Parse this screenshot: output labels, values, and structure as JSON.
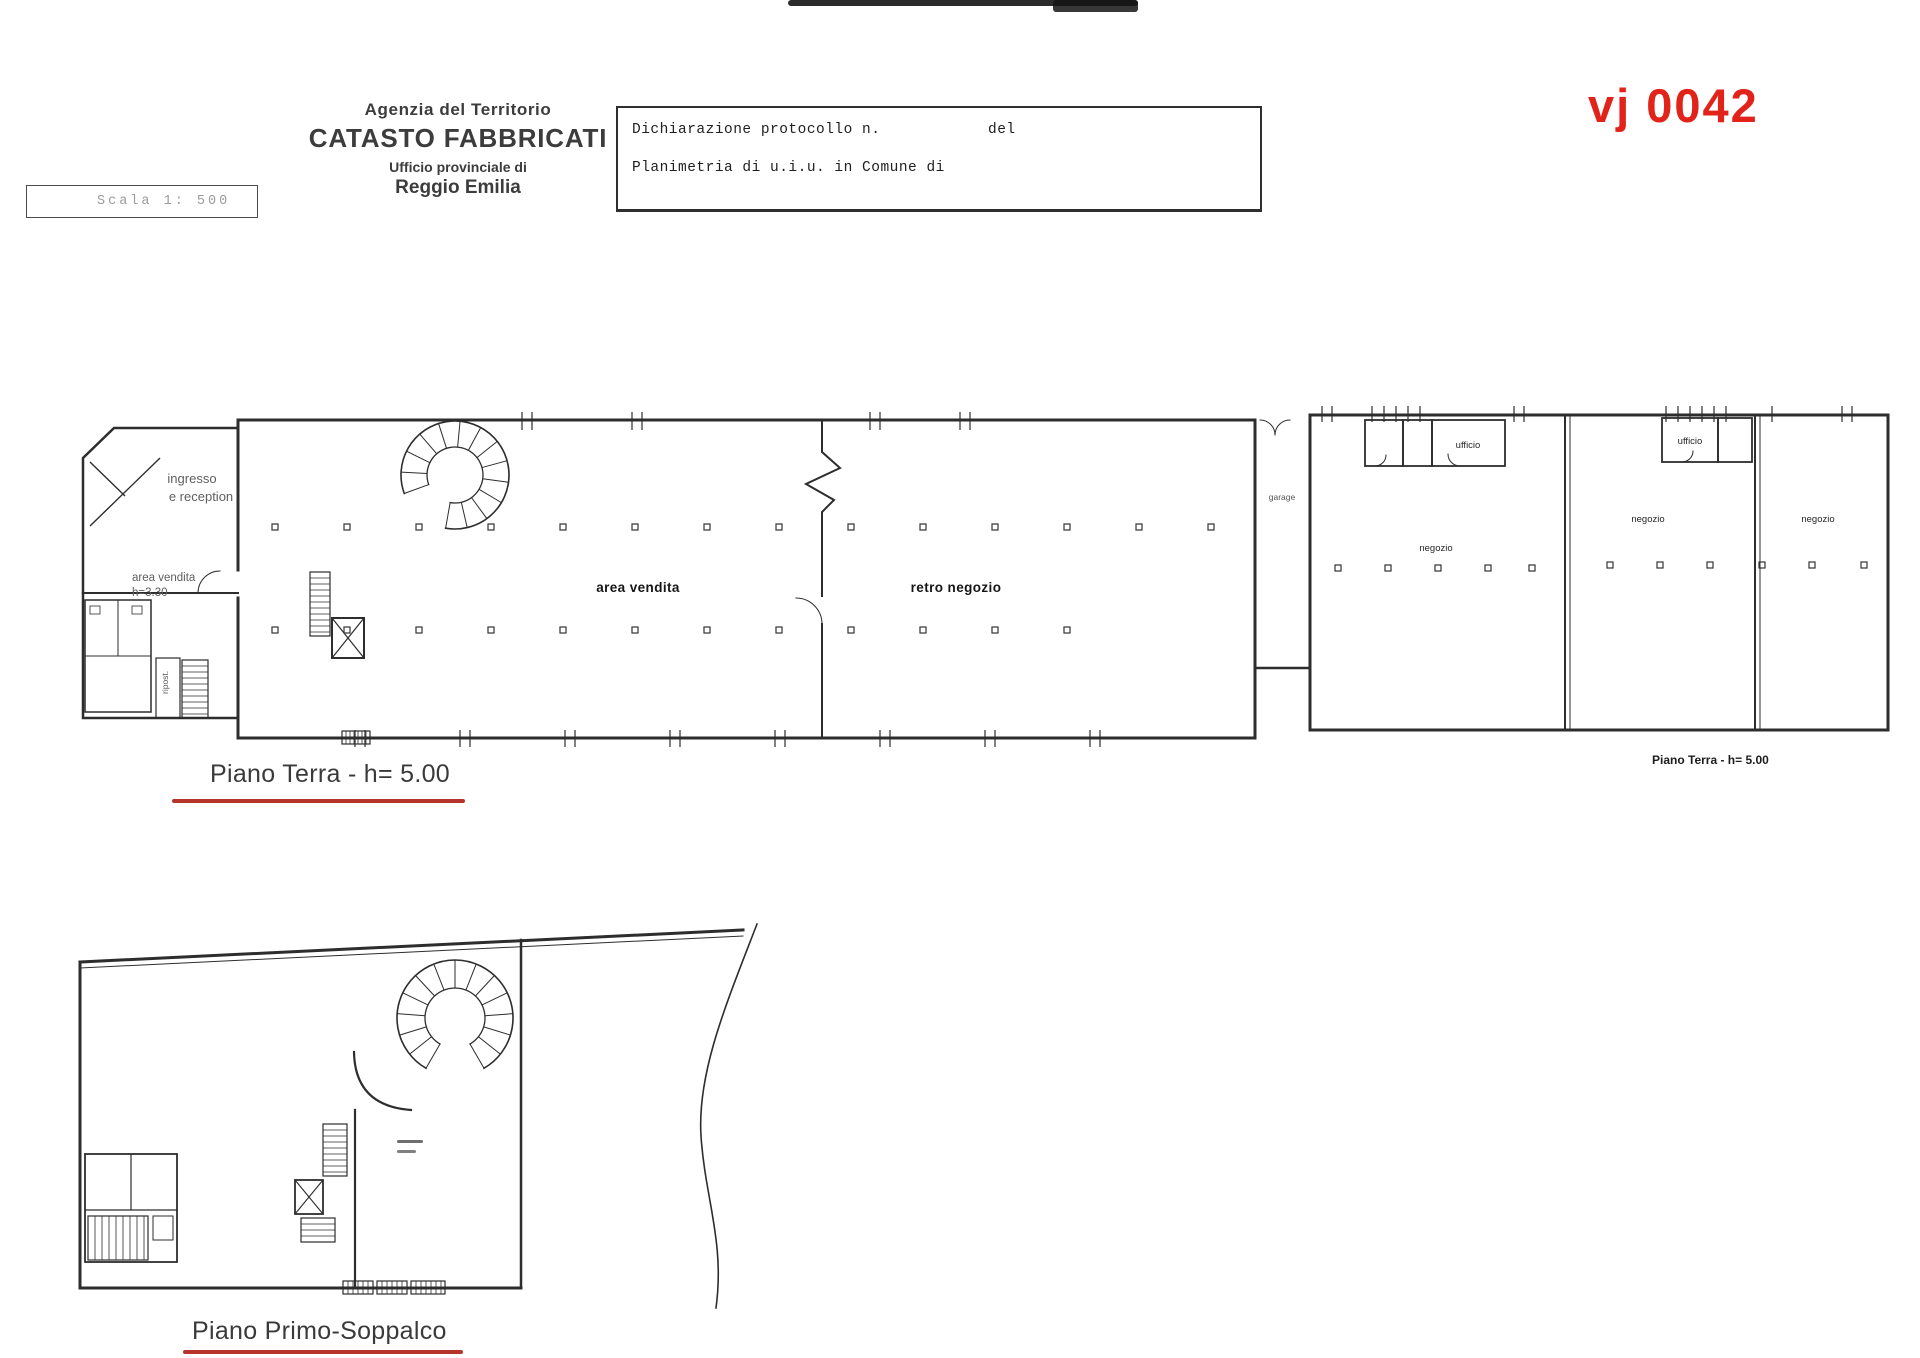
{
  "document": {
    "stamp": "vj 0042",
    "scale_label": "Scala 1: 500",
    "agency": [
      "Agenzia del Territorio",
      "CATASTO FABBRICATI",
      "Ufficio provinciale di",
      "Reggio Emilia"
    ],
    "protocol": {
      "declaration": "Dichiarazione protocollo n.",
      "del": "del",
      "planimetria": "Planimetria di u.i.u. in Comune di"
    },
    "colors": {
      "stamp_red": "#e2231a",
      "underline_red": "#b5352b",
      "ink": "#2d2d2d"
    }
  },
  "plan_terra": {
    "title": "Piano Terra - h= 5.00",
    "title_right": "Piano Terra - h= 5.00",
    "labels": {
      "ingresso_line1": "ingresso",
      "ingresso_line2": "e reception",
      "vendita_small_line1": "area vendita",
      "vendita_small_line2": "h=3.30",
      "area_vendita": "area vendita",
      "retro_negozio": "retro negozio",
      "garage": "garage",
      "ripostiglio": "ripost.",
      "ufficio_a": "ufficio",
      "ufficio_b": "ufficio",
      "negozio_a": "negozio",
      "negozio_b": "negozio",
      "negozio_c": "negozio"
    }
  },
  "plan_soppalco": {
    "title": "Piano Primo-Soppalco"
  }
}
